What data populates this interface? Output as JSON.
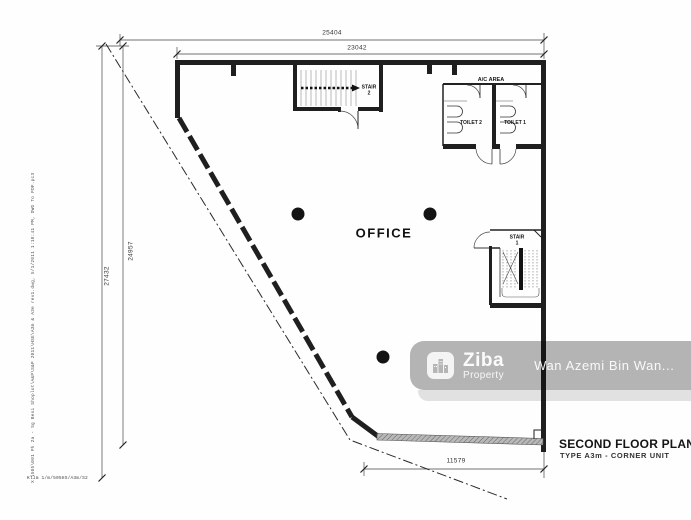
{
  "drawing": {
    "labels": {
      "office": "OFFICE",
      "stair2_line1": "STAIR",
      "stair2_line2": "2",
      "stair1_line1": "STAIR",
      "stair1_line2": "1",
      "ac_area": "A/C AREA",
      "toilet2": "TOILET 2",
      "toilet1": "TOILET 1"
    },
    "dimensions": {
      "top_outer": "25404",
      "top_inner": "23042",
      "left_outer": "27432",
      "left_inner": "24957",
      "bottom": "11579"
    },
    "title_block": {
      "title": "SECOND FLOOR PLAN",
      "subtitle": "TYPE A3m - CORNER UNIT"
    },
    "plot_stamp": {
      "side_text": "X:\\505\\001 Ph 2a - Sg Besi Shoplot\\A&P\\S&P 2011\\HSE\\A3m & A3e rev1.dwg, 5/1/2011 1:18:41 PM, DWG To PDF.pc3",
      "bottom_text": "Kllm  1/m/505HS/A3m/S2"
    }
  },
  "watermark": {
    "brand": "Ziba",
    "brand_sub": "Property",
    "agent": "Wan Azemi Bin Wan...",
    "logo_icon": "building-skyline",
    "band_color": "#b5b5b5",
    "text_color": "#ffffff"
  },
  "colors": {
    "background": "#ffffff",
    "line": "#1f1f1f"
  }
}
